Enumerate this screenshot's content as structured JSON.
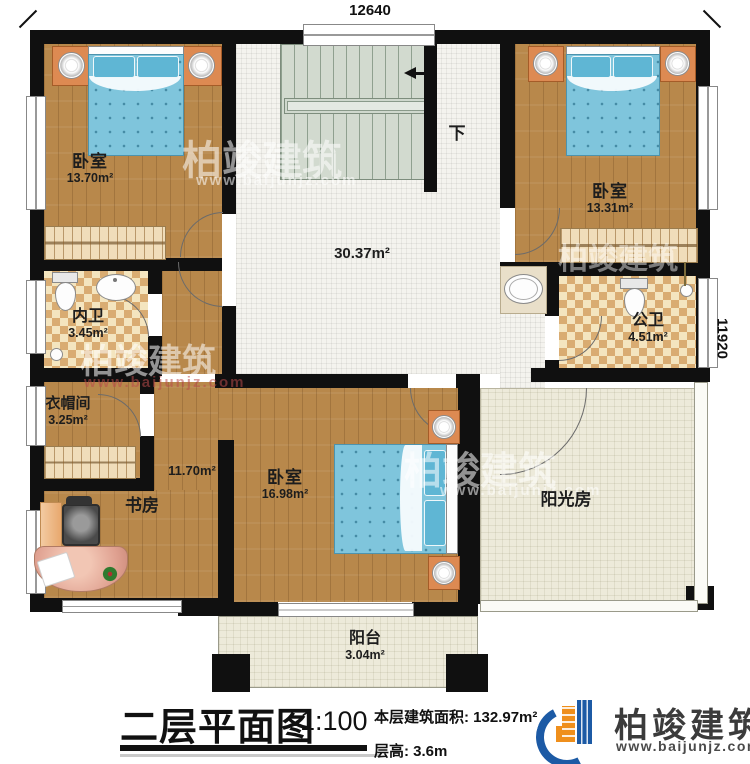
{
  "plan": {
    "dimensions": {
      "top": "12640",
      "right": "11920"
    },
    "stairs": {
      "down_label": "下"
    },
    "rooms": {
      "bedroom_tl": {
        "label": "卧室",
        "area": "13.70m²"
      },
      "bedroom_tr": {
        "label": "卧室",
        "area": "13.31m²"
      },
      "bedroom_main": {
        "label": "卧室",
        "area": "16.98m²"
      },
      "hall": {
        "area": "30.37m²"
      },
      "corridor": {
        "area": "11.70m²"
      },
      "inner_bath": {
        "label": "内卫",
        "area": "3.45m²"
      },
      "public_bath": {
        "label": "公卫",
        "area": "4.51m²"
      },
      "cloakroom": {
        "label": "衣帽间",
        "area": "3.25m²"
      },
      "study": {
        "label": "书房"
      },
      "sunroom": {
        "label": "阳光房"
      },
      "balcony": {
        "label": "阳台",
        "area": "3.04m²"
      }
    }
  },
  "watermark": {
    "brand": "柏竣建筑",
    "url": "www.baijunjz.com"
  },
  "footer": {
    "title": "二层平面图",
    "scale": "1:100",
    "area_line": "本层建筑面积: 132.97m²",
    "height_line": "层高: 3.6m",
    "brand": "柏竣建筑",
    "brand_url": "www.baijunjz.com"
  },
  "colors": {
    "wall": "#101010",
    "wood": "#b8884b",
    "hall_tile": "#f4f3ee",
    "bath_checker_dark": "#d9ac72",
    "bath_checker_light": "#f4e5bf",
    "sun_cream": "#edeada",
    "stairs": "#d2dacf",
    "bed_blue": "#7fc5dc",
    "logo_blue": "#1c5aa5",
    "logo_orange": "#ef8f1c"
  }
}
